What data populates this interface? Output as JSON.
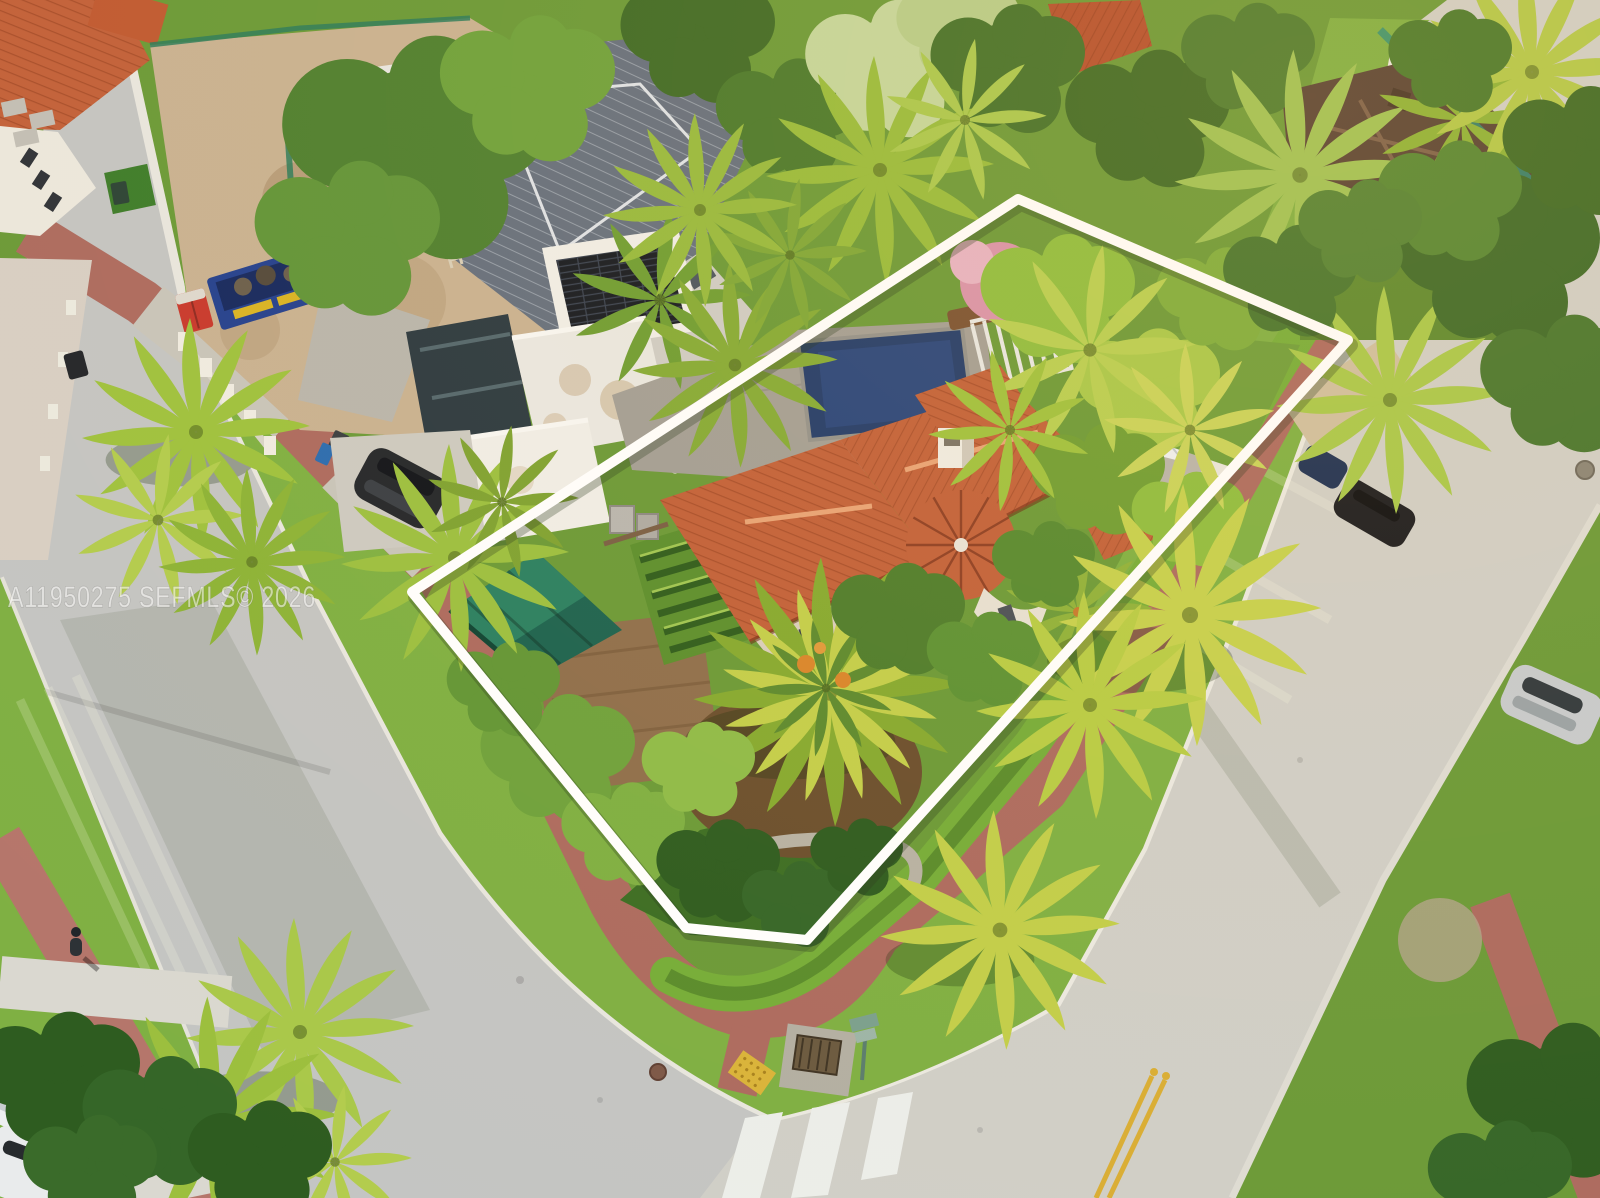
{
  "watermark": {
    "listing_id": "A11950275",
    "mls_name": "SEFMLS",
    "copyright_symbol": "©",
    "year": "2026",
    "full_text": "A11950275  SEFMLS© 2026"
  },
  "palette": {
    "boundary_white": "#ffffff",
    "watermark_white": "rgba(255,255,255,0.55)",
    "road_gray": "#c4c5c3",
    "road_gray_warm": "#d0cfc8",
    "grass_green": "#6b9a38",
    "parkway_green": "#7fb043",
    "lawn_dark_green": "#3c6e24",
    "sand_tan": "#c9b292",
    "roof_terracotta": "#c2613a",
    "roof_terracotta_shadow": "#8e3f24",
    "roof_gray_blue": "#66707e",
    "pool_blue": "#223c6b",
    "awning_green": "#1c6350",
    "brick_path_red": "#ad6b60",
    "brick_path_red_west": "#b5766b",
    "crosswalk_white": "#eceeea",
    "marking_yellow": "#d9ae35",
    "dumpster_blue": "#24418f",
    "portable_toilet_red": "#c8392e",
    "palm_yellow_green": "#b8cf52",
    "canopy_dark_green": "#3f6b26"
  }
}
